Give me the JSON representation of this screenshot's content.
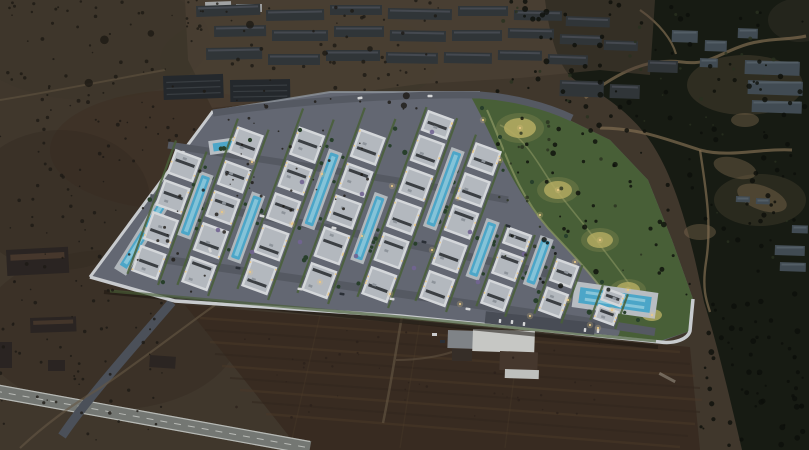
{
  "scene": {
    "type": "aerial-architectural-render",
    "time_of_day": "dusk",
    "description": "Aerial dusk rendering of a large white low-rise residential resort development with turquoise swimming pools, palm-lined streets and an illuminated landscaped park, surrounded by dark scrub hillside, unfinished concrete building shells, tilled farm fields, rural sheds and a highway",
    "regions": [
      "scrubland",
      "construction-site",
      "hillside",
      "residential-complex",
      "landscaped-park",
      "tilled-field",
      "highway",
      "farm-buildings",
      "rural-sheds"
    ]
  },
  "colors": {
    "scrub": "#453a2d",
    "scrub_dark": "#372c22",
    "scrub_olive": "#3e3a28",
    "scrub_red": "#402c1e",
    "field": "#3c2d20",
    "furrow": "#4e3b28",
    "furrow_dark": "#33261b",
    "hill": "#181b11",
    "hill_dark": "#10120b",
    "dirt": "#8a7354",
    "apron": "#57483a",
    "asphalt": "#6b6e79",
    "street": "#5c5f68",
    "wall": "#dadcdf",
    "building": "#e7e9ec",
    "roof": "#c3c7cd",
    "roof_dark": "#3f4246",
    "lawn": "#4e6639",
    "lawn_bright": "#5d7a43",
    "pool": "#52b4d8",
    "pool_light": "#9fdcee",
    "deck": "#c9cdd1",
    "glow": "#c6bb68",
    "light": "#ffd98f",
    "constr": "#33373a",
    "constr_dark": "#26292c",
    "hillbldg": "#465057",
    "shed": "#2c2521",
    "rust": "#54402f",
    "purple": "#7b6a9c",
    "palm": "#2a432b",
    "car_white": "#e8e8e8",
    "car_dark": "#2d3138",
    "highway": "#7e807b",
    "lane": "#c9cac4",
    "track": "#6e5d48",
    "speckle_shrub": "#1e1913",
    "speckle_hill": "#0c0e08",
    "speckle_olive": "#2c331f",
    "speckle_field": "#2e221a",
    "dusk_overlay": "#141c2c"
  }
}
